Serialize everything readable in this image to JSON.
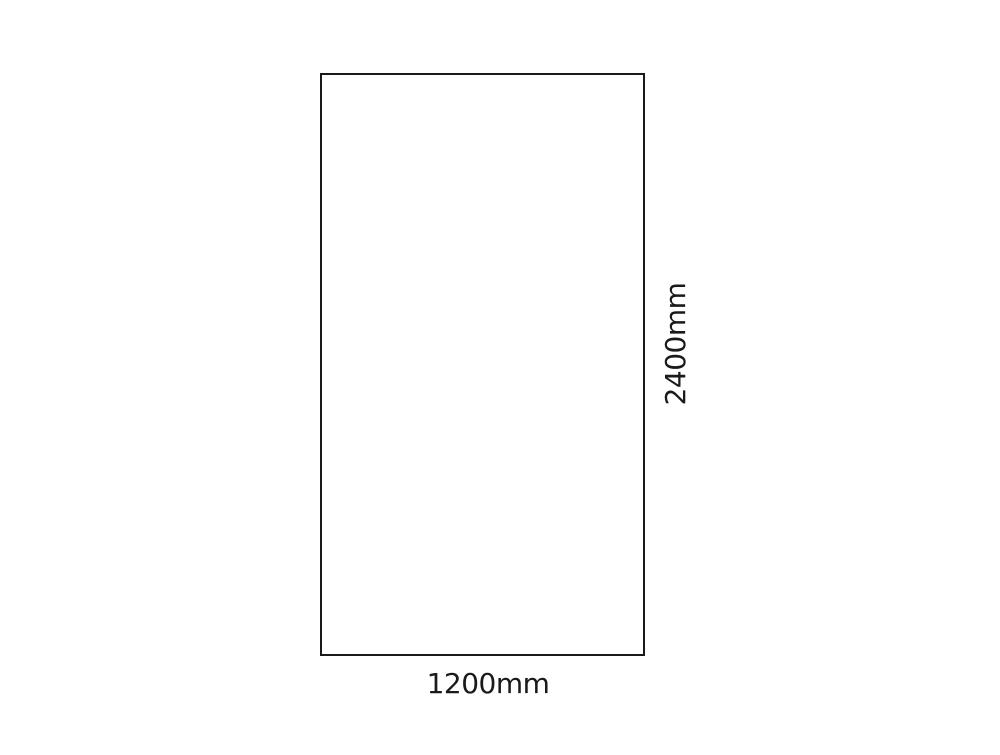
{
  "diagram": {
    "shape": "rectangle-outline",
    "width_label": "1200mm",
    "height_label": "2400mm",
    "width_mm": 1200,
    "height_mm": 2400,
    "colors": {
      "bg": "#ffffff",
      "stroke": "#1a1a1a",
      "text": "#1a1a1a"
    }
  }
}
